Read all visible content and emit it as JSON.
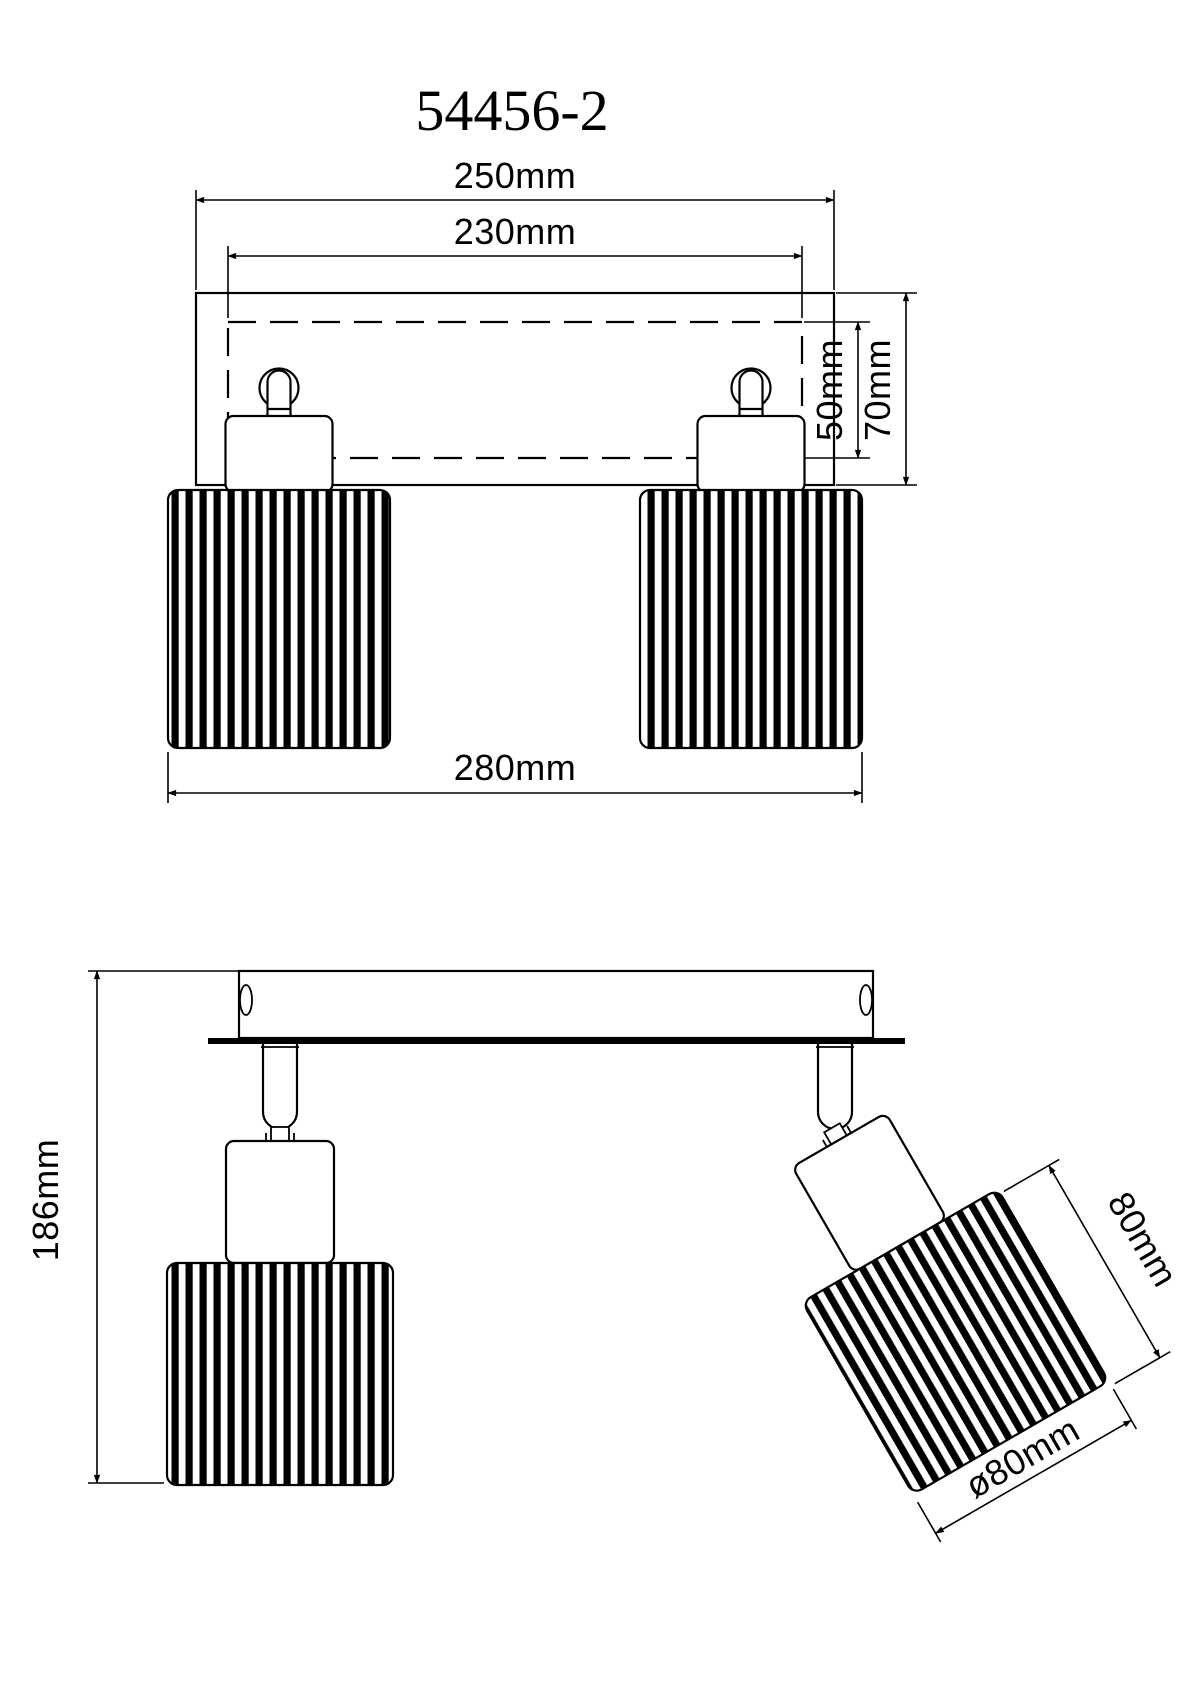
{
  "title": "54456-2",
  "drawing_type": "technical dimension drawing, 2-light spotlight bar",
  "colors": {
    "line": "#000000",
    "background": "#ffffff",
    "shade_stripe": "#000000"
  },
  "front_view": {
    "name": "front-elevation",
    "dims": {
      "overall_width": "250mm",
      "backplate_width": "230mm",
      "backplate_height": "50mm",
      "plate_height": "70mm",
      "shade_span": "280mm"
    }
  },
  "side_view": {
    "name": "side-elevation",
    "dims": {
      "overall_height": "186mm",
      "shade_length": "80mm",
      "shade_diameter": "ø80mm"
    }
  }
}
